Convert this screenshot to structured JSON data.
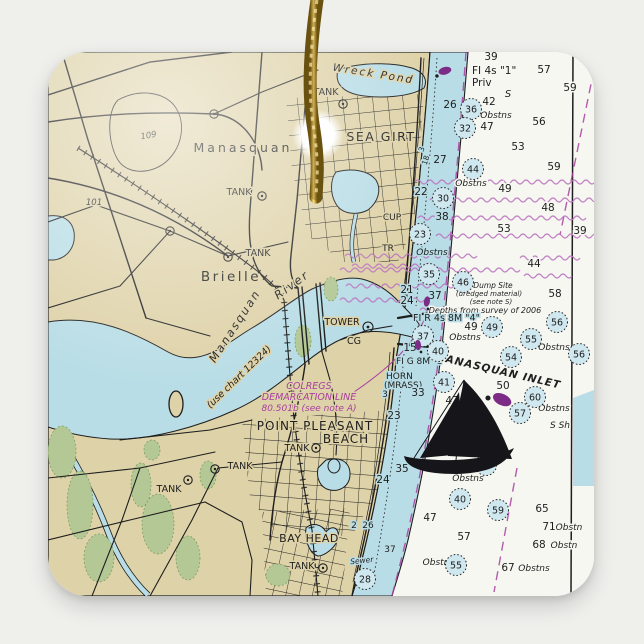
{
  "palette": {
    "background": "#efefec",
    "ornament": "#fafaf6",
    "land": "#ded2a8",
    "water": "#b9dde6",
    "deep_water": "#f7f7f2",
    "marsh": "#b4c896",
    "magenta": "#a93f9f",
    "magenta_light": "#bb74c0",
    "ink": "#1e1e1e",
    "gold_dark": "#6f5410",
    "gold": "#caa23a",
    "gold_light": "#f6e490"
  },
  "chart": {
    "place_labels": [
      {
        "t": "Manasquan",
        "x": 243,
        "y": 152,
        "s": 12.5,
        "sp": 3
      },
      {
        "t": "SEA GIRT",
        "x": 381,
        "y": 141,
        "s": 12.5,
        "sp": 1.5
      },
      {
        "t": "Brielle",
        "x": 231,
        "y": 281,
        "s": 13.5,
        "sp": 2.5
      },
      {
        "t": "POINT PLEASANT",
        "x": 315,
        "y": 430,
        "s": 12,
        "sp": 1
      },
      {
        "t": "BEACH",
        "x": 346,
        "y": 443,
        "s": 12,
        "sp": 1
      },
      {
        "t": "BAY HEAD",
        "x": 309,
        "y": 542,
        "s": 11,
        "sp": 0.5
      },
      {
        "t": "Wreck Pond",
        "x": 373,
        "y": 77,
        "s": 10.5,
        "sp": 2,
        "r": 9,
        "it": 1
      },
      {
        "t": "Manasquan",
        "x": 238,
        "y": 328,
        "s": 11.5,
        "sp": 2,
        "r": -57,
        "it": 1
      },
      {
        "t": "River",
        "x": 294,
        "y": 288,
        "s": 11.5,
        "sp": 2,
        "r": -36,
        "it": 1
      },
      {
        "t": "(use chart 12324)",
        "x": 241,
        "y": 379,
        "s": 9.5,
        "r": -44,
        "it": 1
      },
      {
        "t": "TANK",
        "x": 326,
        "y": 95,
        "s": 9.5
      },
      {
        "t": "TANK",
        "x": 239,
        "y": 195,
        "s": 9.5
      },
      {
        "t": "TANK",
        "x": 258,
        "y": 256,
        "s": 9.5
      },
      {
        "t": "TANK",
        "x": 297,
        "y": 451,
        "s": 9.5
      },
      {
        "t": "TANK",
        "x": 240,
        "y": 469,
        "s": 9.5
      },
      {
        "t": "TANK",
        "x": 169,
        "y": 492,
        "s": 9.5
      },
      {
        "t": "TANK",
        "x": 302,
        "y": 569,
        "s": 9.5
      },
      {
        "t": "CUP",
        "x": 392,
        "y": 220,
        "s": 9
      },
      {
        "t": "TR",
        "x": 388,
        "y": 251,
        "s": 9
      },
      {
        "t": "TOWER",
        "x": 342,
        "y": 325,
        "s": 9.5
      },
      {
        "t": "CG",
        "x": 354,
        "y": 344,
        "s": 9.5
      },
      {
        "t": "109",
        "x": 149,
        "y": 138,
        "s": 8.5,
        "it": 1,
        "r": -10
      },
      {
        "t": "101",
        "x": 94,
        "y": 205,
        "s": 8.5,
        "it": 1
      },
      {
        "t": "Sewer",
        "x": 362,
        "y": 563,
        "s": 7.5,
        "it": 1,
        "r": -6,
        "h": "blue"
      }
    ],
    "nav_labels": [
      {
        "t": "FI 4s \"1\"",
        "x": 472,
        "y": 74,
        "s": 10.5,
        "a": "start"
      },
      {
        "t": "Priv",
        "x": 472,
        "y": 86,
        "s": 10.5,
        "a": "start"
      },
      {
        "t": "S",
        "x": 508,
        "y": 97,
        "s": 10,
        "it": 1
      },
      {
        "t": "Dump Site",
        "x": 493,
        "y": 288,
        "s": 7.5,
        "it": 1
      },
      {
        "t": "(dredged material)",
        "x": 489,
        "y": 296,
        "s": 7,
        "it": 1
      },
      {
        "t": "(see note S)",
        "x": 491,
        "y": 304,
        "s": 7,
        "it": 1
      },
      {
        "t": "Depths from survey of 2006",
        "x": 485,
        "y": 313,
        "s": 8,
        "it": 1
      },
      {
        "t": "FI R 4s 8M \"4\"",
        "x": 413,
        "y": 321,
        "s": 9.5,
        "a": "start",
        "h": "blue"
      },
      {
        "t": "FI G 8M \"3\"",
        "x": 396,
        "y": 364,
        "s": 9,
        "a": "start",
        "h": "blue"
      },
      {
        "t": "HORN",
        "x": 386,
        "y": 379,
        "s": 9,
        "a": "start",
        "h": "blue"
      },
      {
        "t": "(MRASS)",
        "x": 384,
        "y": 388,
        "s": 9,
        "a": "start",
        "h": "blue"
      },
      {
        "t": "MANASQUAN INLET",
        "x": 497,
        "y": 374,
        "s": 10.5,
        "it": 1,
        "b": 1,
        "r": 13,
        "sp": 1
      },
      {
        "t": "S Sh",
        "x": 560,
        "y": 428,
        "s": 9,
        "it": 1
      },
      {
        "t": "3",
        "x": 424,
        "y": 150,
        "s": 7.5,
        "r": -72,
        "h": "blue"
      },
      {
        "t": "18",
        "x": 428,
        "y": 161,
        "s": 7.5,
        "r": -72,
        "h": "blue"
      }
    ],
    "magenta_labels": [
      {
        "t": "COLREGS",
        "x": 309,
        "y": 389,
        "s": 9.5
      },
      {
        "t": "DEMARCATION LINE",
        "x": 309,
        "y": 400,
        "s": 9.5
      },
      {
        "t": "80.501b (see note A)",
        "x": 309,
        "y": 411,
        "s": 9
      }
    ],
    "obstns_labels": [
      {
        "t": "Obstns",
        "x": 496,
        "y": 118
      },
      {
        "t": "Obstns",
        "x": 471,
        "y": 186
      },
      {
        "t": "Obstns",
        "x": 432,
        "y": 255,
        "h": "blue"
      },
      {
        "t": "Obstns",
        "x": 465,
        "y": 340
      },
      {
        "t": "Obstns",
        "x": 554,
        "y": 350
      },
      {
        "t": "Obstns",
        "x": 554,
        "y": 411
      },
      {
        "t": "Obstns",
        "x": 468,
        "y": 481
      },
      {
        "t": "Obstns",
        "x": 534,
        "y": 571
      },
      {
        "t": "Obstn",
        "x": 569,
        "y": 530
      },
      {
        "t": "Obstn",
        "x": 564,
        "y": 548
      },
      {
        "t": "Obstn",
        "x": 436,
        "y": 565
      }
    ],
    "depth_numbers": [
      {
        "v": "39",
        "x": 491,
        "y": 60
      },
      {
        "v": "57",
        "x": 544,
        "y": 73
      },
      {
        "v": "59",
        "x": 570,
        "y": 91
      },
      {
        "v": "42",
        "x": 489,
        "y": 105
      },
      {
        "v": "26",
        "x": 450,
        "y": 108,
        "h": "blue"
      },
      {
        "v": "47",
        "x": 487,
        "y": 130
      },
      {
        "v": "56",
        "x": 539,
        "y": 125
      },
      {
        "v": "53",
        "x": 518,
        "y": 150
      },
      {
        "v": "59",
        "x": 554,
        "y": 170
      },
      {
        "v": "49",
        "x": 505,
        "y": 192
      },
      {
        "v": "27",
        "x": 440,
        "y": 163,
        "h": "blue"
      },
      {
        "v": "22",
        "x": 421,
        "y": 195,
        "h": "blue"
      },
      {
        "v": "48",
        "x": 548,
        "y": 211
      },
      {
        "v": "38",
        "x": 442,
        "y": 220,
        "h": "blue"
      },
      {
        "v": "53",
        "x": 504,
        "y": 232
      },
      {
        "v": "39",
        "x": 580,
        "y": 234
      },
      {
        "v": "44",
        "x": 534,
        "y": 267
      },
      {
        "v": "58",
        "x": 555,
        "y": 297
      },
      {
        "v": "37",
        "x": 435,
        "y": 299,
        "h": "blue"
      },
      {
        "v": "21",
        "x": 407,
        "y": 293,
        "h": "blue"
      },
      {
        "v": "24",
        "x": 407,
        "y": 304,
        "h": "blue"
      },
      {
        "v": "49",
        "x": 471,
        "y": 330
      },
      {
        "v": "50",
        "x": 503,
        "y": 389
      },
      {
        "v": "33",
        "x": 418,
        "y": 396,
        "h": "blue"
      },
      {
        "v": "3",
        "x": 385,
        "y": 397,
        "s": 9,
        "h": "blue"
      },
      {
        "v": "23",
        "x": 394,
        "y": 419,
        "h": "blue"
      },
      {
        "v": "47",
        "x": 452,
        "y": 404
      },
      {
        "v": "35",
        "x": 402,
        "y": 472,
        "h": "blue"
      },
      {
        "v": "24",
        "x": 383,
        "y": 483,
        "h": "blue"
      },
      {
        "v": "65",
        "x": 542,
        "y": 512
      },
      {
        "v": "71",
        "x": 549,
        "y": 530
      },
      {
        "v": "68",
        "x": 539,
        "y": 548
      },
      {
        "v": "67",
        "x": 508,
        "y": 571
      },
      {
        "v": "57",
        "x": 464,
        "y": 540
      },
      {
        "v": "15",
        "x": 410,
        "y": 351,
        "h": "blue"
      },
      {
        "v": "2",
        "x": 354,
        "y": 528,
        "s": 9,
        "h": "blue"
      },
      {
        "v": "26",
        "x": 368,
        "y": 528,
        "s": 9,
        "h": "blue"
      },
      {
        "v": "37",
        "x": 390,
        "y": 552,
        "s": 9,
        "h": "blue"
      },
      {
        "v": "47",
        "x": 430,
        "y": 521
      }
    ],
    "circled_depths": [
      {
        "v": "36",
        "x": 471,
        "y": 109
      },
      {
        "v": "32",
        "x": 465,
        "y": 128
      },
      {
        "v": "44",
        "x": 473,
        "y": 169
      },
      {
        "v": "30",
        "x": 443,
        "y": 198
      },
      {
        "v": "23",
        "x": 420,
        "y": 234
      },
      {
        "v": "35",
        "x": 429,
        "y": 274
      },
      {
        "v": "46",
        "x": 463,
        "y": 282
      },
      {
        "v": "37",
        "x": 423,
        "y": 336
      },
      {
        "v": "40",
        "x": 438,
        "y": 351
      },
      {
        "v": "49",
        "x": 492,
        "y": 327
      },
      {
        "v": "56",
        "x": 557,
        "y": 322
      },
      {
        "v": "55",
        "x": 531,
        "y": 339
      },
      {
        "v": "54",
        "x": 511,
        "y": 357
      },
      {
        "v": "41",
        "x": 444,
        "y": 382
      },
      {
        "v": "60",
        "x": 535,
        "y": 397
      },
      {
        "v": "57",
        "x": 520,
        "y": 413
      },
      {
        "v": "55",
        "x": 486,
        "y": 465
      },
      {
        "v": "40",
        "x": 460,
        "y": 499
      },
      {
        "v": "59",
        "x": 498,
        "y": 510
      },
      {
        "v": "55",
        "x": 456,
        "y": 565
      },
      {
        "v": "28",
        "x": 365,
        "y": 579
      },
      {
        "v": "56",
        "x": 579,
        "y": 354
      }
    ],
    "symbols": {
      "tank_circles": [
        [
          343,
          104
        ],
        [
          262,
          196
        ],
        [
          228,
          257
        ],
        [
          316,
          448
        ],
        [
          215,
          469
        ],
        [
          188,
          480
        ],
        [
          323,
          568
        ],
        [
          214,
          114
        ],
        [
          170,
          231
        ]
      ],
      "tower_circle": [
        368,
        327
      ],
      "light_flags": [
        [
          437,
          76,
          -15,
          1
        ],
        [
          428,
          309,
          -80,
          0.8
        ],
        [
          421,
          352,
          -95,
          0.8
        ],
        [
          488,
          398,
          25,
          1.5
        ]
      ]
    }
  }
}
